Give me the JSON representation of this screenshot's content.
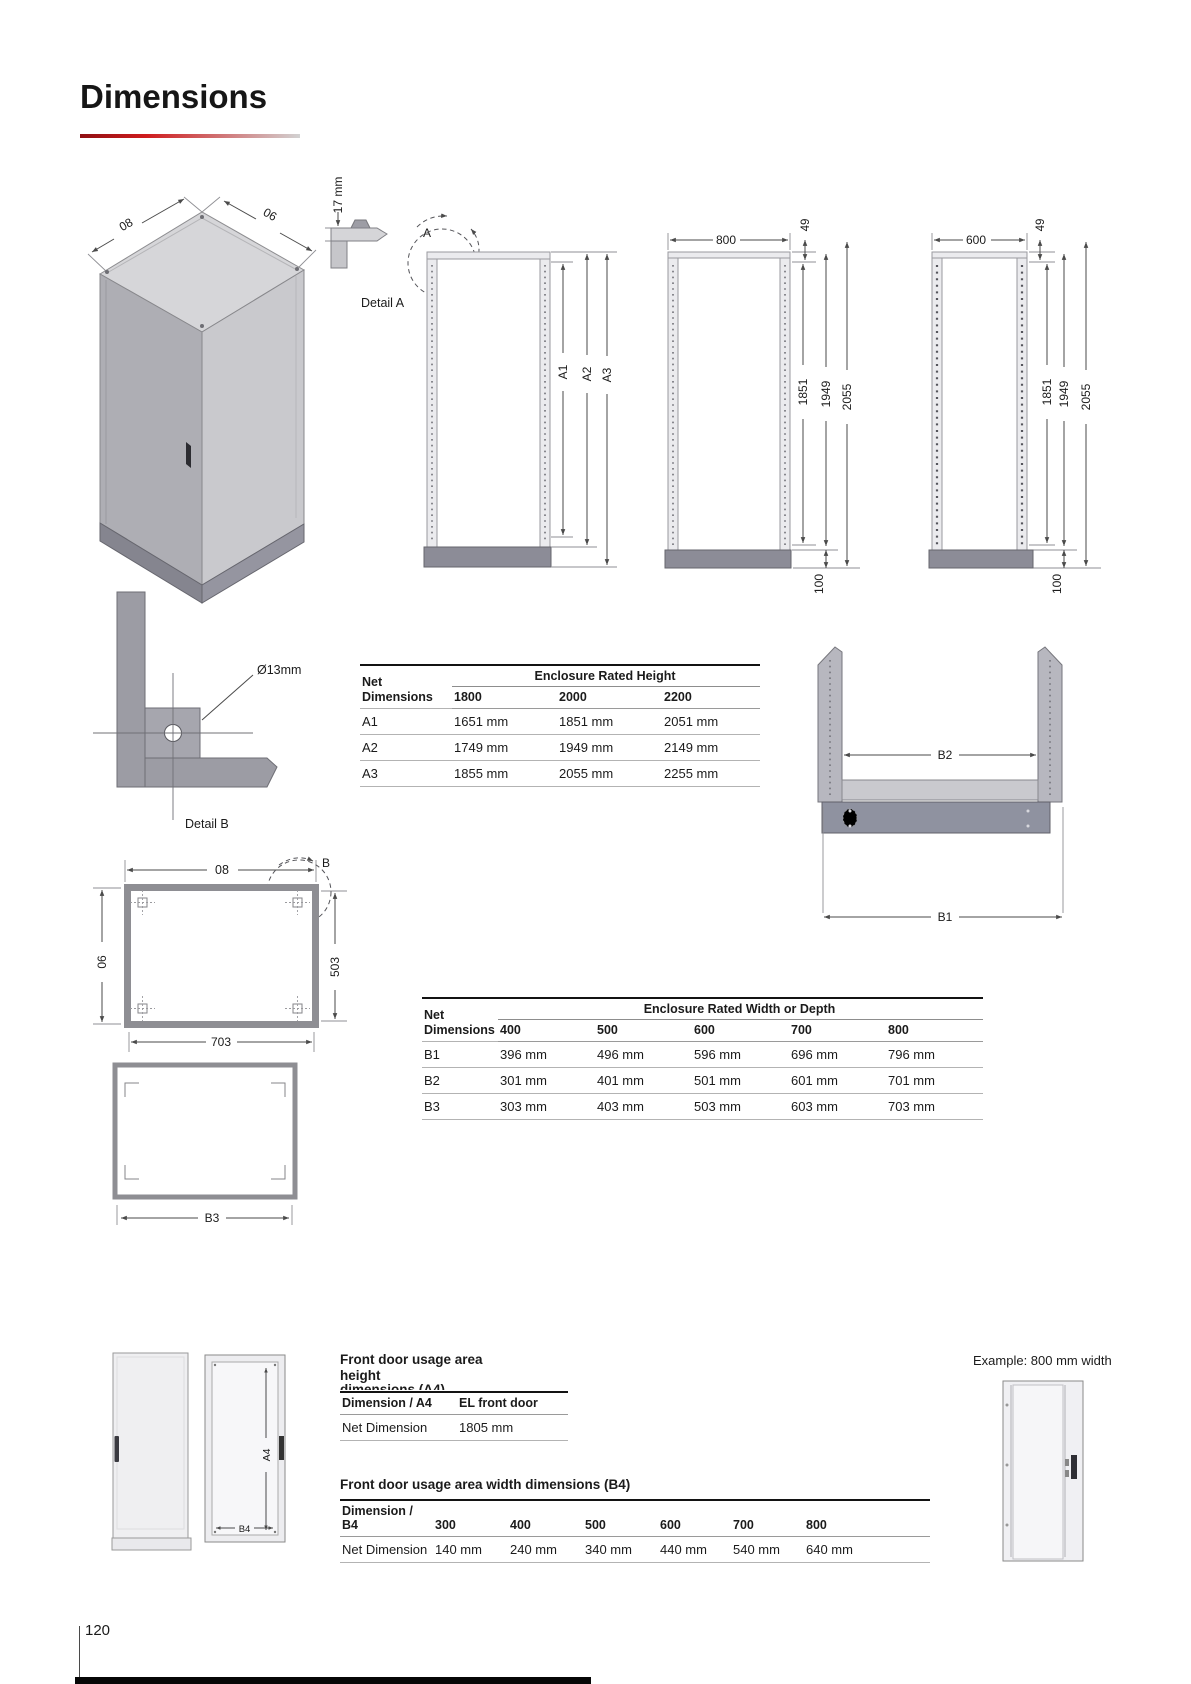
{
  "page": {
    "title": "Dimensions",
    "page_number": "120"
  },
  "tables": {
    "height": {
      "corner": "Net Dimensions",
      "group": "Enclosure Rated Height",
      "cols": [
        "1800",
        "2000",
        "2200"
      ],
      "rows": [
        {
          "label": "A1",
          "values": [
            "1651 mm",
            "1851 mm",
            "2051 mm"
          ]
        },
        {
          "label": "A2",
          "values": [
            "1749 mm",
            "1949 mm",
            "2149 mm"
          ]
        },
        {
          "label": "A3",
          "values": [
            "1855 mm",
            "2055 mm",
            "2255 mm"
          ]
        }
      ]
    },
    "width": {
      "corner": "Net Dimensions",
      "group": "Enclosure Rated Width or Depth",
      "cols": [
        "400",
        "500",
        "600",
        "700",
        "800"
      ],
      "rows": [
        {
          "label": "B1",
          "values": [
            "396 mm",
            "496 mm",
            "596 mm",
            "696 mm",
            "796 mm"
          ]
        },
        {
          "label": "B2",
          "values": [
            "301 mm",
            "401 mm",
            "501 mm",
            "601 mm",
            "701 mm"
          ]
        },
        {
          "label": "B3",
          "values": [
            "303 mm",
            "403 mm",
            "503 mm",
            "603 mm",
            "703 mm"
          ]
        }
      ]
    },
    "door_height": {
      "heading_top": "Front door usage area",
      "heading_bottom": "height",
      "heading_clipped": "dimensions (A4)",
      "header": [
        "Dimension / A4",
        "EL front door"
      ],
      "row": [
        "Net Dimension",
        "1805 mm"
      ]
    },
    "door_width": {
      "heading": "Front door usage area width dimensions (B4)",
      "header": [
        "Dimension / B4",
        "300",
        "400",
        "500",
        "600",
        "700",
        "800"
      ],
      "row": [
        "Net Dimension",
        "140 mm",
        "240 mm",
        "340 mm",
        "440 mm",
        "540 mm",
        "640 mm"
      ]
    }
  },
  "drawings": {
    "iso": {
      "dim_left": "08",
      "dim_right": "06"
    },
    "profile": {
      "offset": "17 mm",
      "detail_ref": "A",
      "detail_caption": "Detail A",
      "dims": [
        "A1",
        "A2",
        "A3"
      ]
    },
    "front800": {
      "width": "800",
      "top_offset": "49",
      "heights": [
        "1851",
        "1949",
        "2055"
      ],
      "plinth_height": "100"
    },
    "front600": {
      "width": "600",
      "top_offset": "49",
      "heights": [
        "1851",
        "1949",
        "2055"
      ],
      "plinth_height": "100"
    },
    "detail_b": {
      "hole_diameter": "Ø13mm",
      "caption": "Detail B"
    },
    "channel": {
      "inner_width": "B2",
      "outer_width": "B1"
    },
    "plan": {
      "top": "08",
      "detail_ref": "B",
      "left": "06",
      "right": "503",
      "bottom": "703"
    },
    "plan_b3": {
      "bottom": "B3"
    },
    "door_frame": {
      "height": "A4",
      "width": "B4"
    },
    "example": {
      "caption": "Example: 800 mm width"
    }
  }
}
